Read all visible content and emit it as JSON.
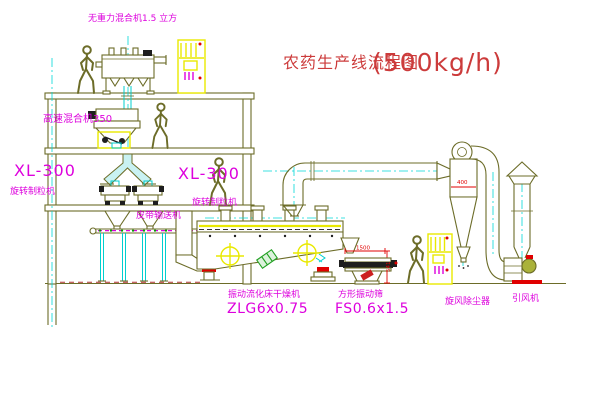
{
  "title": {
    "name": "农药生产线流程图",
    "capacity": "(500kg/h)"
  },
  "equipment_labels": {
    "gravity_mixer": "无重力混合机1.5 立方",
    "high_speed_mixer": "高速混合机350",
    "granulator_left_model": "XL-300",
    "granulator_left_name": "旋转制粒机",
    "granulator_center_model": "XL-300",
    "granulator_center_name": "旋转制粒机",
    "belt_conveyor": "皮带输送机",
    "fluid_bed_dryer_name": "振动流化床干燥机",
    "fluid_bed_dryer_model": "ZLG6x0.75",
    "vibrating_sieve_name": "方形振动筛",
    "vibrating_sieve_model": "FS0.6x1.5",
    "cyclone": "旋风除尘器",
    "induced_draft_fan": "引风机"
  },
  "dimensions": {
    "sieve_length": "1500",
    "sieve_height": "541",
    "cyclone_width": "400"
  },
  "colors": {
    "line_olive": "#6c6c28",
    "label_magenta": "#dd00dd",
    "title_red": "#cc3b3b",
    "highlight_yellow": "#e9e900",
    "pipe_cyan": "#00cfcf",
    "signal_red": "#e00000",
    "belt_green": "#00a000"
  }
}
